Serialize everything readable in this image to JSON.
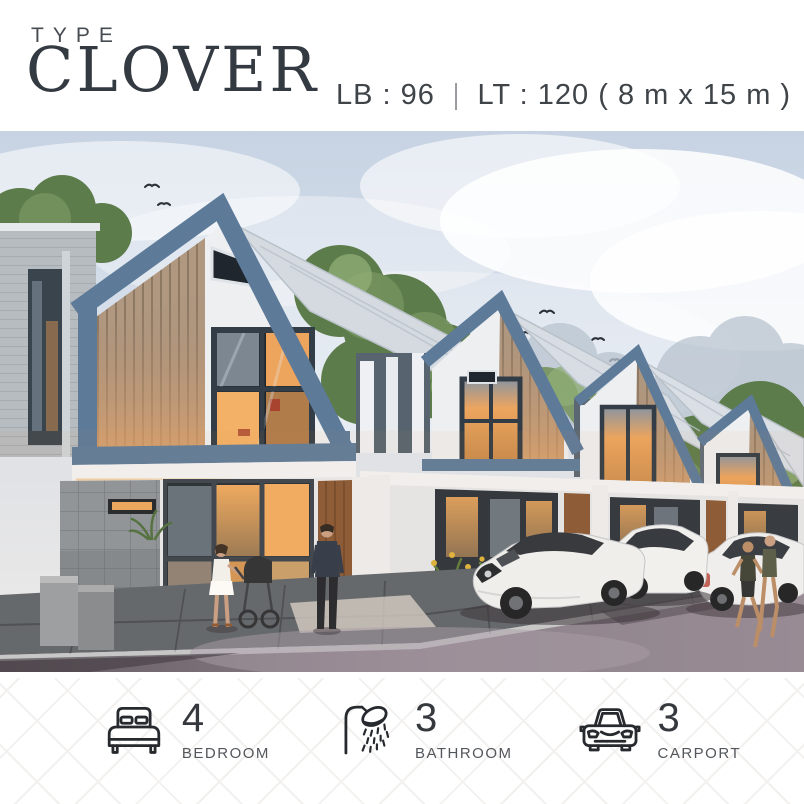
{
  "header": {
    "type_label": "TYPE",
    "title": "CLOVER",
    "spec_lb": "LB : 96",
    "spec_divider": "|",
    "spec_lt": "LT : 120 ( 8 m x 15 m )"
  },
  "hero": {
    "name": "townhouse-street-render",
    "description": "Row of two-storey gabled townhouses at dusk with steel-blue frames, wood slat panels, warm glowing windows, white parked cars, pedestrians with a stroller, joggers, trees and birds over a paved street"
  },
  "features": [
    {
      "icon": "bed-icon",
      "value": "4",
      "label": "BEDROOM"
    },
    {
      "icon": "shower-icon",
      "value": "3",
      "label": "BATHROOM"
    },
    {
      "icon": "car-icon",
      "value": "3",
      "label": "CARPORT"
    }
  ],
  "colors": {
    "text": "#343a41",
    "label": "#53575c",
    "accent_steel_blue": "#5d7a99",
    "wood": "#c2915f",
    "window_glow": "#f0a85c",
    "sky": "#c9d4e4",
    "road": "#837b87"
  }
}
